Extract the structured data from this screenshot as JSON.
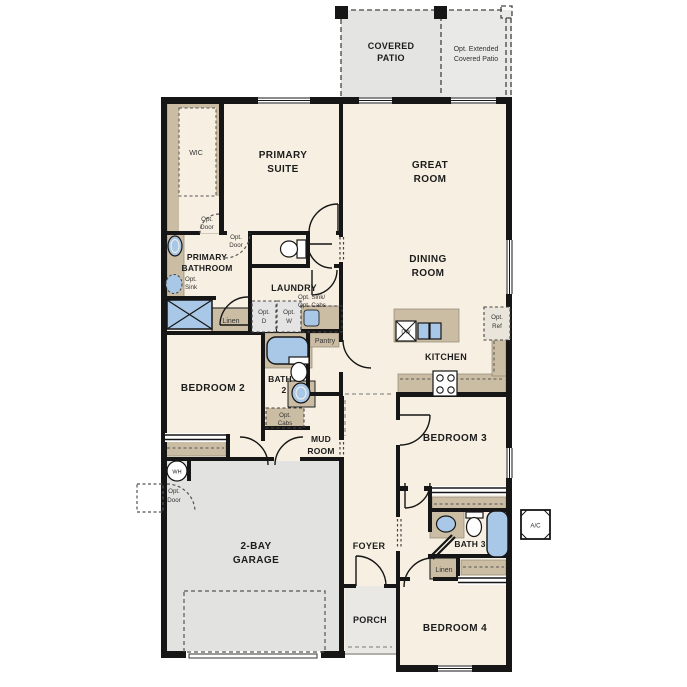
{
  "plan_title": "Single-story floor plan",
  "colors": {
    "wall": "#161616",
    "floor_cream": "#f7f0e2",
    "tan": "#cbbda4",
    "garage_gray": "#e2e2e0",
    "porch_gray": "#e9e8e4",
    "patio_gray": "#e4e4e2",
    "fixture_blue": "#a9c7e6",
    "dashed_gray": "#555555"
  },
  "rooms": {
    "covered_patio": {
      "line1": "COVERED",
      "line2": "PATIO"
    },
    "opt_extended_patio": {
      "line1": "Opt. Extended",
      "line2": "Covered Patio"
    },
    "wic": {
      "label": "WIC"
    },
    "primary_suite": {
      "line1": "PRIMARY",
      "line2": "SUITE"
    },
    "great_room": {
      "line1": "GREAT",
      "line2": "ROOM"
    },
    "dining_room": {
      "line1": "DINING",
      "line2": "ROOM"
    },
    "primary_bathroom": {
      "line1": "PRIMARY",
      "line2": "BATHROOM"
    },
    "laundry": {
      "label": "LAUNDRY"
    },
    "bedroom2": {
      "label": "BEDROOM 2"
    },
    "bath2": {
      "line1": "BATH",
      "line2": "2"
    },
    "mud_room": {
      "line1": "MUD",
      "line2": "ROOM"
    },
    "kitchen": {
      "label": "KITCHEN"
    },
    "bedroom3": {
      "label": "BEDROOM 3"
    },
    "bath3": {
      "label": "BATH 3"
    },
    "bedroom4": {
      "label": "BEDROOM 4"
    },
    "foyer": {
      "label": "FOYER"
    },
    "porch": {
      "label": "PORCH"
    },
    "garage": {
      "line1": "2-BAY",
      "line2": "GARAGE"
    }
  },
  "features": {
    "pantry": "Pantry",
    "linen_hall": "Linen",
    "linen_bath3": "Linen",
    "water_heater": "WH",
    "ac_unit": "A/C",
    "dishwasher": "DW",
    "opt_door": {
      "line1": "Opt.",
      "line2": "Door"
    },
    "opt_sink": {
      "line1": "Opt.",
      "line2": "Sink"
    },
    "opt_dryer": {
      "line1": "Opt.",
      "line2": "D"
    },
    "opt_washer": {
      "line1": "Opt.",
      "line2": "W"
    },
    "opt_sink_cabs": {
      "line1": "Opt. Sink/",
      "line2": "Opt. Cabs"
    },
    "opt_cabs": {
      "line1": "Opt.",
      "line2": "Cabs"
    },
    "opt_ref": {
      "line1": "Opt.",
      "line2": "Ref"
    }
  }
}
